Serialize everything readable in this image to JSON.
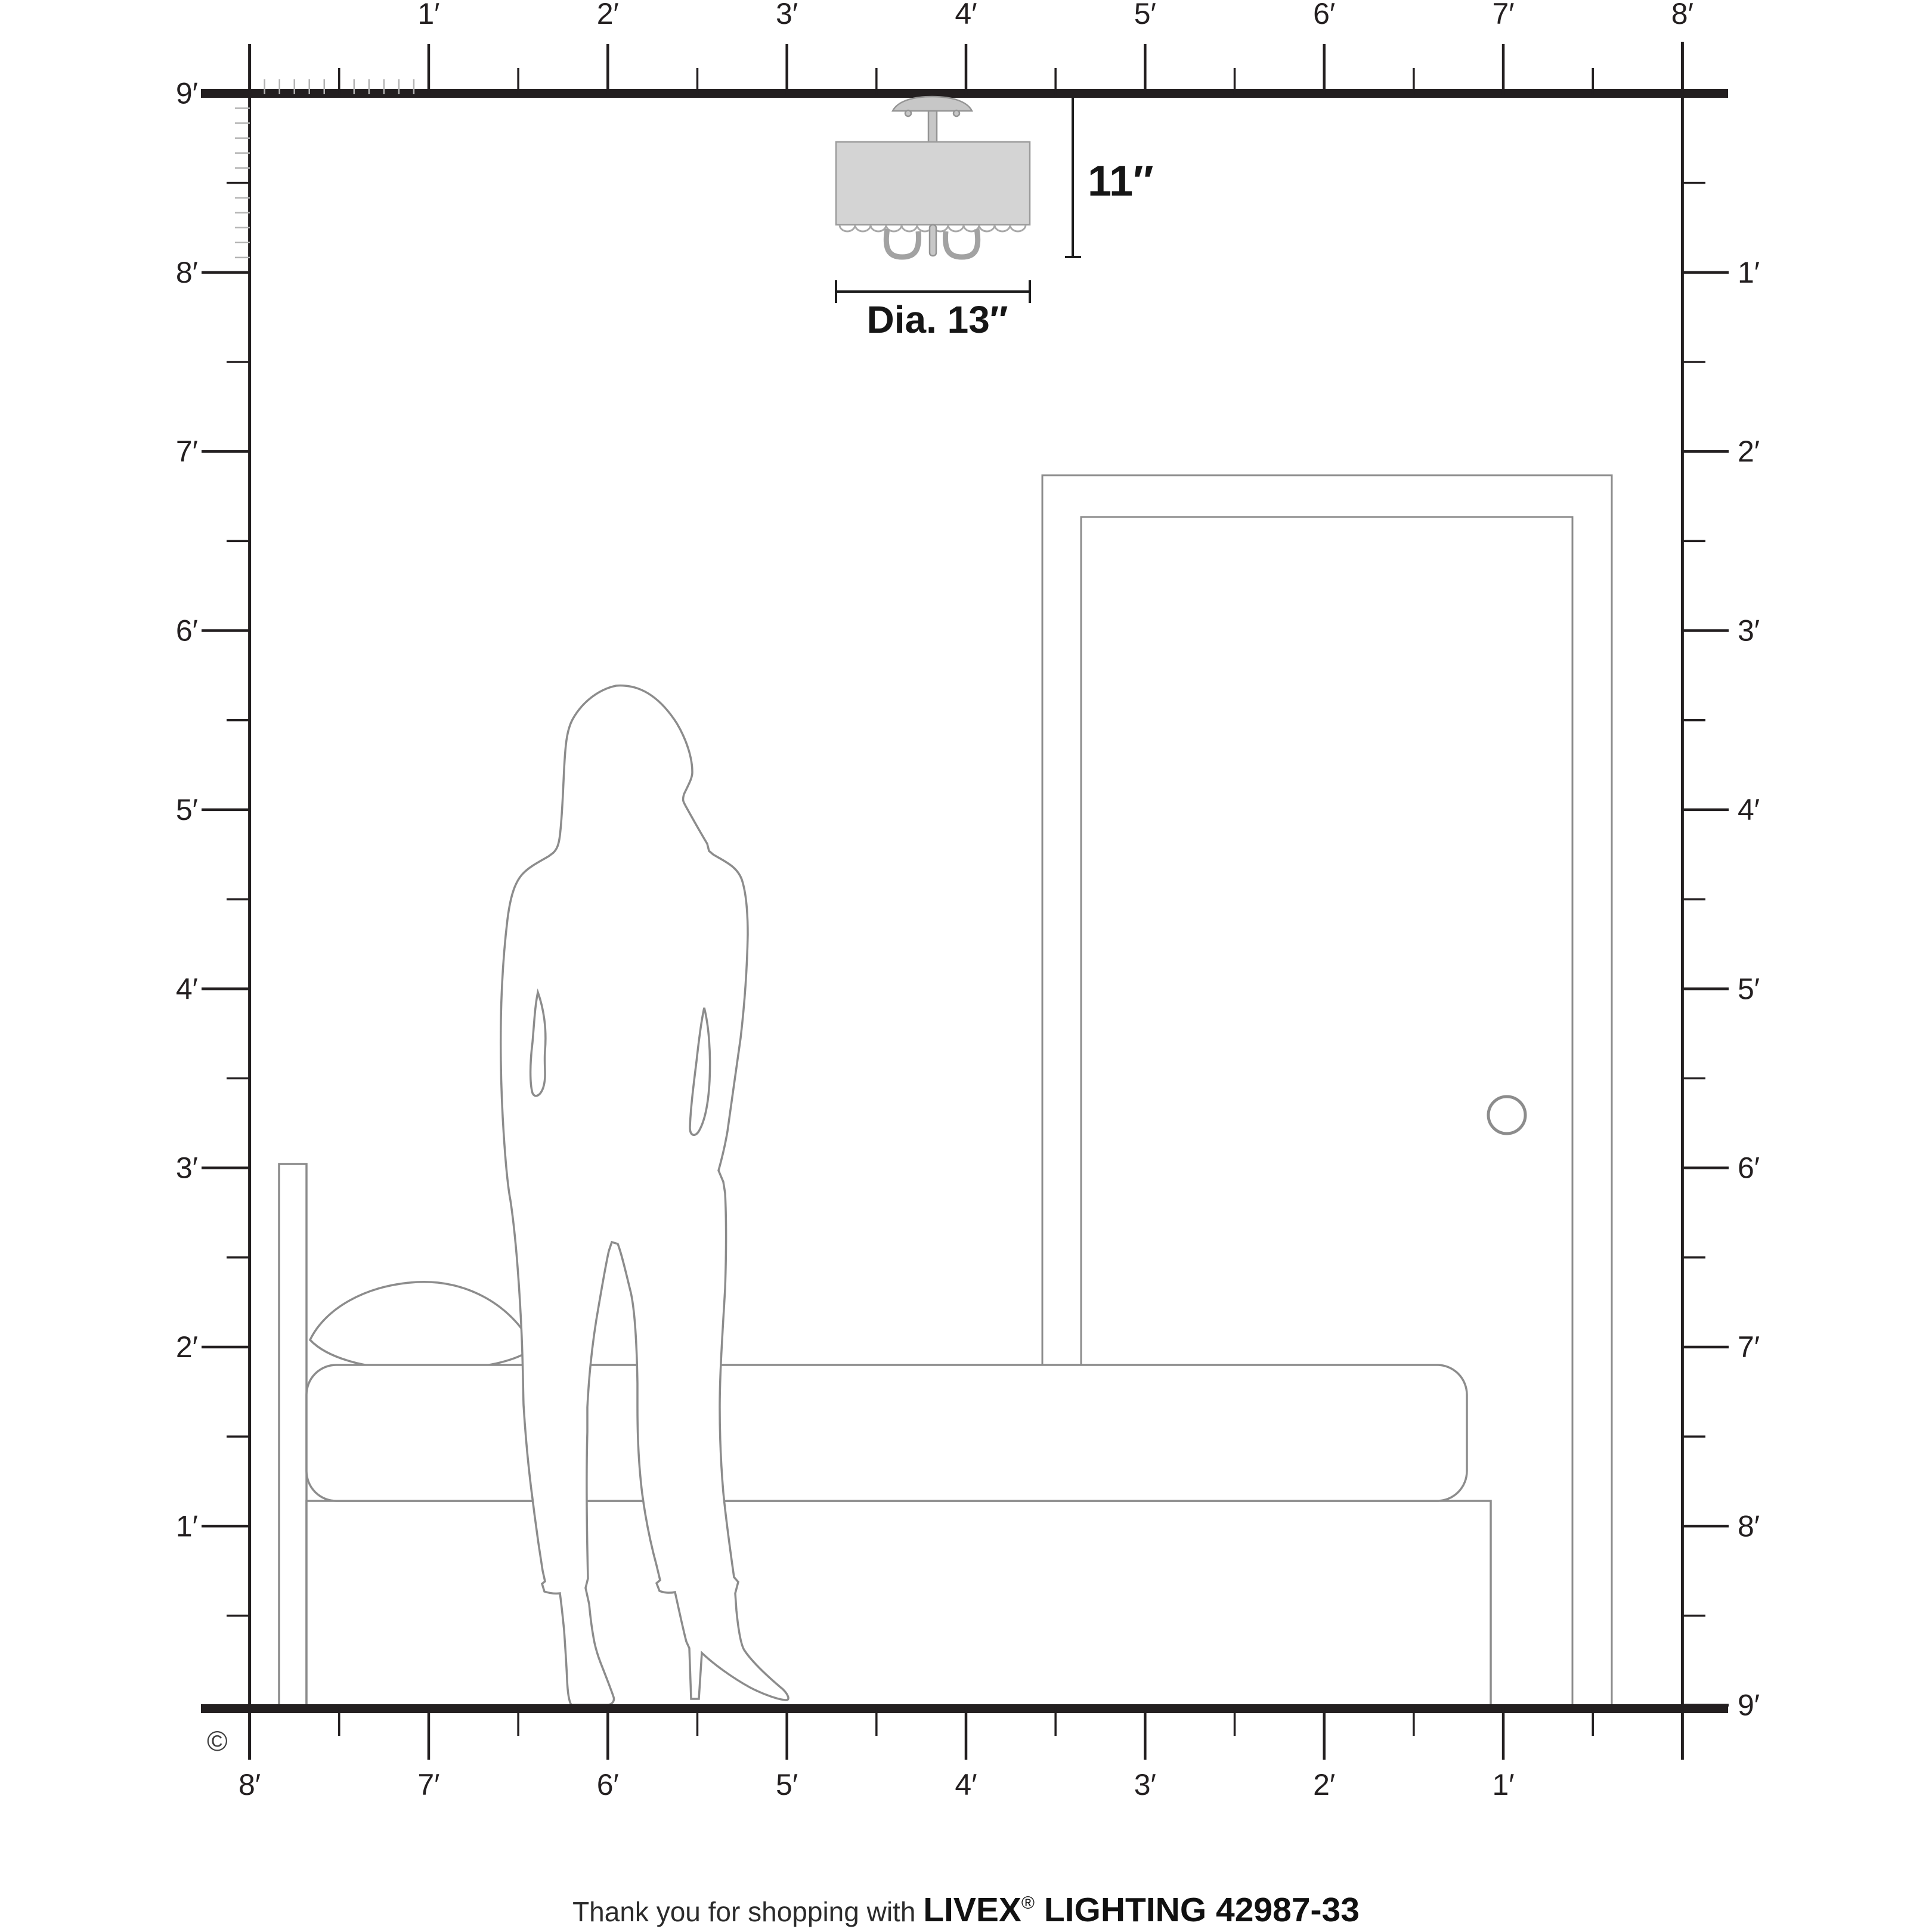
{
  "annotations": {
    "height_label": "11″",
    "diameter_label": "Dia. 13″"
  },
  "rulers": {
    "top": {
      "labels": [
        "1′",
        "2′",
        "3′",
        "4′",
        "5′",
        "6′",
        "7′",
        "8′"
      ]
    },
    "left": {
      "labels": [
        "9′",
        "8′",
        "7′",
        "6′",
        "5′",
        "4′",
        "3′",
        "2′",
        "1′"
      ]
    },
    "right": {
      "labels": [
        "1′",
        "2′",
        "3′",
        "4′",
        "5′",
        "6′",
        "7′",
        "8′",
        "9′"
      ]
    },
    "bottom": {
      "labels": [
        "8′",
        "7′",
        "6′",
        "5′",
        "4′",
        "3′",
        "2′",
        "1′"
      ]
    }
  },
  "copyright_mark": "©",
  "footer": {
    "prefix": "Thank you for shopping with ",
    "brand": "LIVEX",
    "registered_mark": "®",
    "suffix": " LIGHTING 42987-33"
  },
  "colors": {
    "structure": "#231f20",
    "furniture_outline": "#8c8c8c",
    "inch_tick": "#b3b3b3",
    "shade_fill": "#d4d4d4",
    "metal_fill": "#c7c7c7"
  }
}
